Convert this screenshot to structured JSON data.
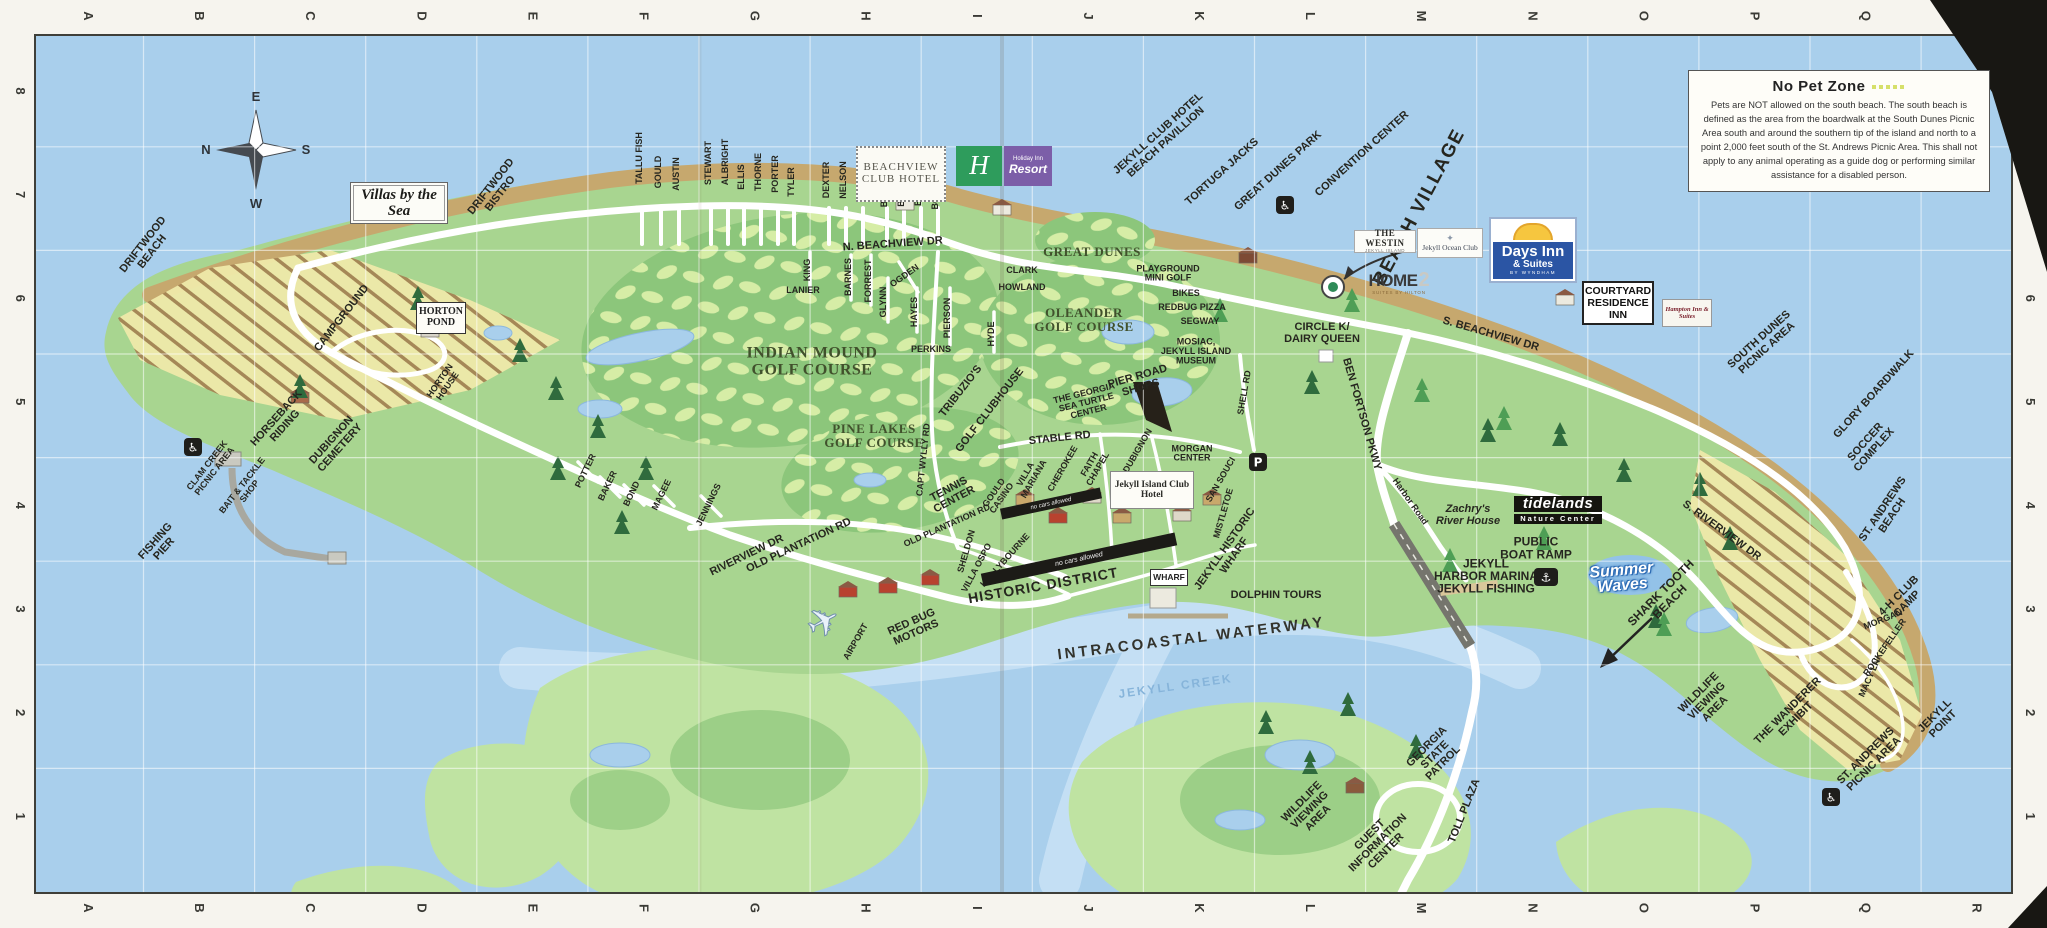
{
  "map": {
    "title": "Jekyll Island visitor map",
    "grid": {
      "columns": [
        "A",
        "B",
        "C",
        "D",
        "E",
        "F",
        "G",
        "H",
        "I",
        "J",
        "K",
        "L",
        "M",
        "N",
        "O",
        "P",
        "Q",
        "R"
      ],
      "rows_top_to_bottom": [
        "8",
        "7",
        "6",
        "5",
        "4",
        "3",
        "2",
        "1"
      ]
    },
    "no_pet_zone": {
      "title": "No Pet Zone",
      "body": "Pets are NOT allowed on the south beach. The south beach is defined as the area from the boardwalk at the South Dunes Picnic Area south and around the southern tip of the island and north to a point 2,000 feet south of the St. Andrews Picnic Area. This shall not apply to any animal operating as a guide dog or performing similar assistance for a disabled person."
    },
    "logos": {
      "villas": {
        "text": "Villas by the Sea"
      },
      "beachview": {
        "line1": "BEACHVIEW",
        "line2": "CLUB HOTEL"
      },
      "holiday": {
        "h": "H",
        "brand": "Holiday Inn",
        "sub": "Resort"
      },
      "westin": {
        "name": "THE WESTIN",
        "sub": "JEKYLL ISLAND"
      },
      "oceanclub": {
        "crest": "✦",
        "name": "Jekyll Ocean Club"
      },
      "days": {
        "name": "Days Inn",
        "sub": "& Suites",
        "tiny": "BY WYNDHAM"
      },
      "home2": {
        "name": "HOME",
        "num": "2",
        "sub": "SUITES BY HILTON"
      },
      "courtyard": {
        "line1": "COURTYARD",
        "line2": "RESIDENCE",
        "line3": "INN"
      },
      "hampton": {
        "name": "Hampton Inn & Suites"
      },
      "jekyllclub": {
        "name": "Jekyll Island Club Hotel"
      },
      "hortonpond": {
        "line1": "HORTON",
        "line2": "POND"
      },
      "wharf": {
        "name": "WHARF"
      },
      "tidelands": {
        "name": "tidelands",
        "sub": "Nature Center"
      },
      "summerwaves": {
        "line1": "Summer",
        "line2": "Waves"
      },
      "nocars": {
        "text": "no cars allowed"
      }
    },
    "icons": [
      {
        "type": "wheelchair",
        "g": "♿",
        "x": 193,
        "y": 447
      },
      {
        "type": "wheelchair",
        "g": "♿",
        "x": 1285,
        "y": 205
      },
      {
        "type": "wheelchair",
        "g": "♿",
        "x": 1831,
        "y": 797
      },
      {
        "type": "parking",
        "g": "P",
        "x": 1258,
        "y": 462
      },
      {
        "type": "boat-ramp",
        "g": "⚓",
        "x": 1546,
        "y": 577
      },
      {
        "type": "airplane",
        "g": "✈",
        "x": 830,
        "y": 634
      }
    ],
    "labels": [
      {
        "t": "N",
        "x": 206,
        "y": 154,
        "c": "lcomp"
      },
      {
        "t": "E",
        "x": 256,
        "y": 101,
        "c": "lcomp"
      },
      {
        "t": "S",
        "x": 306,
        "y": 154,
        "c": "lcomp"
      },
      {
        "t": "W",
        "x": 256,
        "y": 208,
        "c": "lcomp"
      },
      {
        "t": "DRIFTWOOD\nBEACH",
        "x": 150,
        "y": 250,
        "r": -52,
        "c": "ls"
      },
      {
        "t": "DRIFTWOOD\nBISTRO",
        "x": 498,
        "y": 192,
        "r": -52,
        "c": "ls"
      },
      {
        "t": "CAMPGROUND",
        "x": 344,
        "y": 320,
        "r": -52,
        "c": "ls"
      },
      {
        "t": "HORTON\nHOUSE",
        "x": 446,
        "y": 385,
        "r": -55,
        "c": "lt"
      },
      {
        "t": "HORSEBACK\nRIDING",
        "x": 283,
        "y": 424,
        "r": -48,
        "c": "ls"
      },
      {
        "t": "DUBIGNON\nCEMETERY",
        "x": 338,
        "y": 446,
        "r": -48,
        "c": "ls"
      },
      {
        "t": "CLAM CREEK\nPICNIC AREA",
        "x": 213,
        "y": 470,
        "r": -52,
        "c": "lt"
      },
      {
        "t": "BAIT & TACKLE\nSHOP",
        "x": 248,
        "y": 490,
        "r": -52,
        "c": "lt"
      },
      {
        "t": "FISHING\nPIER",
        "x": 162,
        "y": 547,
        "r": -48,
        "c": "ls"
      },
      {
        "t": "TALLU FISH",
        "x": 642,
        "y": 158,
        "r": -90,
        "c": "lt"
      },
      {
        "t": "GOULD",
        "x": 661,
        "y": 172,
        "r": -90,
        "c": "lt"
      },
      {
        "t": "AUSTIN",
        "x": 679,
        "y": 174,
        "r": -90,
        "c": "lt"
      },
      {
        "t": "STEWART",
        "x": 711,
        "y": 163,
        "r": -90,
        "c": "lt"
      },
      {
        "t": "ALBRIGHT",
        "x": 728,
        "y": 162,
        "r": -90,
        "c": "lt"
      },
      {
        "t": "ELLIS",
        "x": 744,
        "y": 177,
        "r": -90,
        "c": "lt"
      },
      {
        "t": "THORNE",
        "x": 761,
        "y": 172,
        "r": -90,
        "c": "lt"
      },
      {
        "t": "PORTER",
        "x": 778,
        "y": 174,
        "r": -90,
        "c": "lt"
      },
      {
        "t": "TYLER",
        "x": 794,
        "y": 182,
        "r": -90,
        "c": "lt"
      },
      {
        "t": "DEXTER",
        "x": 829,
        "y": 180,
        "r": -90,
        "c": "lt"
      },
      {
        "t": "NELSON",
        "x": 846,
        "y": 180,
        "r": -90,
        "c": "lt"
      },
      {
        "t": "KING",
        "x": 863,
        "y": 190,
        "r": -90,
        "c": "lt"
      },
      {
        "t": "BLISS",
        "x": 887,
        "y": 194,
        "r": -90,
        "c": "lt"
      },
      {
        "t": "BARRON",
        "x": 904,
        "y": 187,
        "r": -90,
        "c": "lt"
      },
      {
        "t": "BRICE",
        "x": 921,
        "y": 192,
        "r": -90,
        "c": "lt"
      },
      {
        "t": "BORDEN",
        "x": 938,
        "y": 190,
        "r": -90,
        "c": "lt"
      },
      {
        "t": "LANIER",
        "x": 803,
        "y": 293,
        "c": "lt"
      },
      {
        "t": "KING",
        "x": 810,
        "y": 270,
        "r": -90,
        "c": "lt"
      },
      {
        "t": "BARNES",
        "x": 851,
        "y": 277,
        "r": -90,
        "c": "lt"
      },
      {
        "t": "FORREST",
        "x": 871,
        "y": 281,
        "r": -90,
        "c": "lt"
      },
      {
        "t": "GLYNN",
        "x": 886,
        "y": 302,
        "r": -90,
        "c": "lt"
      },
      {
        "t": "OGDEN",
        "x": 906,
        "y": 278,
        "r": -35,
        "c": "lt"
      },
      {
        "t": "HAYES",
        "x": 917,
        "y": 312,
        "r": -90,
        "c": "lt"
      },
      {
        "t": "PIERSON",
        "x": 950,
        "y": 318,
        "r": -90,
        "c": "lt"
      },
      {
        "t": "PERKINS",
        "x": 931,
        "y": 352,
        "c": "lt"
      },
      {
        "t": "HYDE",
        "x": 994,
        "y": 334,
        "r": -90,
        "c": "lt"
      },
      {
        "t": "CLARK",
        "x": 1022,
        "y": 273,
        "c": "lt"
      },
      {
        "t": "HOWLAND",
        "x": 1022,
        "y": 290,
        "c": "lt"
      },
      {
        "t": "N. BEACHVIEW DR",
        "x": 893,
        "y": 247,
        "r": -4,
        "c": "ls"
      },
      {
        "t": "S. BEACHVIEW DR",
        "x": 1490,
        "y": 337,
        "r": 16,
        "c": "ls"
      },
      {
        "t": "OLD PLANTATION RD",
        "x": 800,
        "y": 548,
        "r": -25,
        "c": "ls"
      },
      {
        "t": "OLD PLANTATION RD",
        "x": 948,
        "y": 528,
        "r": -24,
        "c": "lt"
      },
      {
        "t": "RIVERVIEW DR",
        "x": 748,
        "y": 558,
        "r": -26,
        "c": "ls"
      },
      {
        "t": "CAPT WYLLY RD",
        "x": 926,
        "y": 460,
        "r": -84,
        "c": "lt"
      },
      {
        "t": "STABLE RD",
        "x": 1060,
        "y": 441,
        "r": -6,
        "c": "ls"
      },
      {
        "t": "SHELL RD",
        "x": 1247,
        "y": 393,
        "r": -80,
        "c": "lt"
      },
      {
        "t": "BEN FORTSON PKWY",
        "x": 1359,
        "y": 415,
        "r": 74,
        "c": "ls"
      },
      {
        "t": "Harbor Road",
        "x": 1408,
        "y": 503,
        "r": 55,
        "c": "lt"
      },
      {
        "t": "S. RIVERVIEW DR",
        "x": 1720,
        "y": 533,
        "r": 36,
        "c": "ls"
      },
      {
        "t": "TOLL PLAZA",
        "x": 1467,
        "y": 812,
        "r": -68,
        "c": "ls"
      },
      {
        "t": "MORGAN",
        "x": 1884,
        "y": 622,
        "r": -22,
        "c": "lt"
      },
      {
        "t": "ROCKEFELLER",
        "x": 1887,
        "y": 649,
        "r": -55,
        "c": "lt"
      },
      {
        "t": "MACY LN",
        "x": 1872,
        "y": 679,
        "r": -66,
        "c": "lt"
      },
      {
        "t": "POTTER",
        "x": 588,
        "y": 472,
        "r": -64,
        "c": "lt"
      },
      {
        "t": "BAKER",
        "x": 610,
        "y": 487,
        "r": -64,
        "c": "lt"
      },
      {
        "t": "BOND",
        "x": 634,
        "y": 495,
        "r": -64,
        "c": "lt"
      },
      {
        "t": "MAGEE",
        "x": 664,
        "y": 496,
        "r": -64,
        "c": "lt"
      },
      {
        "t": "JENNINGS",
        "x": 711,
        "y": 506,
        "r": -64,
        "c": "lt"
      },
      {
        "t": "INDIAN MOUND\nGOLF COURSE",
        "x": 812,
        "y": 366,
        "c": "lse"
      },
      {
        "t": "PINE LAKES\nGOLF COURSE",
        "x": 874,
        "y": 440,
        "c": "lse2"
      },
      {
        "t": "OLEANDER\nGOLF COURSE",
        "x": 1084,
        "y": 324,
        "c": "lse2"
      },
      {
        "t": "GREAT DUNES",
        "x": 1092,
        "y": 256,
        "c": "lse2"
      },
      {
        "t": "JEKYLL CLUB HOTEL\nBEACH PAVILLION",
        "x": 1164,
        "y": 140,
        "r": -42,
        "c": "ls"
      },
      {
        "t": "TORTUGA JACKS",
        "x": 1224,
        "y": 174,
        "r": -42,
        "c": "ls"
      },
      {
        "t": "GREAT DUNES PARK",
        "x": 1280,
        "y": 173,
        "r": -42,
        "c": "ls"
      },
      {
        "t": "CONVENTION CENTER",
        "x": 1364,
        "y": 156,
        "r": -42,
        "c": "ls"
      },
      {
        "t": "BEACH VILLAGE",
        "x": 1424,
        "y": 210,
        "r": -62,
        "c": "lbig"
      },
      {
        "t": "PLAYGROUND\nMINI GOLF",
        "x": 1168,
        "y": 276,
        "c": "lt"
      },
      {
        "t": "BIKES",
        "x": 1186,
        "y": 296,
        "c": "lt"
      },
      {
        "t": "REDBUG PIZZA",
        "x": 1192,
        "y": 310,
        "c": "lt"
      },
      {
        "t": "SEGWAY",
        "x": 1200,
        "y": 324,
        "c": "lt"
      },
      {
        "t": "MOSIAC,\nJEKYLL ISLAND\nMUSEUM",
        "x": 1196,
        "y": 354,
        "c": "lt"
      },
      {
        "t": "CIRCLE K/\nDAIRY QUEEN",
        "x": 1322,
        "y": 336,
        "c": "ls"
      },
      {
        "t": "TRIBUZIO'S",
        "x": 963,
        "y": 393,
        "r": -52,
        "c": "ls"
      },
      {
        "t": "GOLF CLUBHOUSE",
        "x": 992,
        "y": 412,
        "r": -52,
        "c": "ls"
      },
      {
        "t": "TENNIS\nCENTER",
        "x": 953,
        "y": 497,
        "r": -28,
        "c": "ls"
      },
      {
        "t": "THE GEORGIA\nSEA TURTLE\nCENTER",
        "x": 1087,
        "y": 405,
        "r": -14,
        "c": "lt"
      },
      {
        "t": "PIER ROAD\nSHOPS",
        "x": 1140,
        "y": 385,
        "r": -16,
        "c": "ls"
      },
      {
        "t": "GOULD\nCASINO",
        "x": 1000,
        "y": 497,
        "r": -55,
        "c": "lt"
      },
      {
        "t": "SHELDON",
        "x": 969,
        "y": 552,
        "r": -74,
        "c": "lt"
      },
      {
        "t": "VILLA OSPO",
        "x": 979,
        "y": 569,
        "r": -62,
        "c": "lt"
      },
      {
        "t": "HOLLYBOURNE",
        "x": 1007,
        "y": 562,
        "r": -48,
        "c": "lt"
      },
      {
        "t": "VILLA\nMARIANA",
        "x": 1032,
        "y": 478,
        "r": -60,
        "c": "lt"
      },
      {
        "t": "CHEROKEE",
        "x": 1065,
        "y": 470,
        "r": -60,
        "c": "lt"
      },
      {
        "t": "FAITH\nCHAPEL",
        "x": 1096,
        "y": 468,
        "r": -60,
        "c": "lt"
      },
      {
        "t": "DUBIGNON",
        "x": 1140,
        "y": 452,
        "r": -60,
        "c": "lt"
      },
      {
        "t": "MORGAN\nCENTER",
        "x": 1192,
        "y": 456,
        "c": "lt"
      },
      {
        "t": "SAN SOUCI",
        "x": 1223,
        "y": 481,
        "r": -60,
        "c": "lt"
      },
      {
        "t": "MISTLETOE",
        "x": 1226,
        "y": 514,
        "r": -74,
        "c": "lt"
      },
      {
        "t": "HISTORIC DISTRICT",
        "x": 1044,
        "y": 590,
        "r": -10,
        "c": "lhd"
      },
      {
        "t": "JEKYLL HISTORIC\nWHARF",
        "x": 1232,
        "y": 554,
        "r": -55,
        "c": "ls"
      },
      {
        "t": "DOLPHIN TOURS",
        "x": 1276,
        "y": 598,
        "c": "ls"
      },
      {
        "t": "AIRPORT",
        "x": 858,
        "y": 643,
        "r": -60,
        "c": "lt"
      },
      {
        "t": "RED BUG\nMOTORS",
        "x": 915,
        "y": 630,
        "r": -24,
        "c": "ls"
      },
      {
        "t": "INTRACOASTAL WATERWAY",
        "x": 1192,
        "y": 643,
        "r": -7,
        "c": "lws"
      },
      {
        "t": "JEKYLL CREEK",
        "x": 1176,
        "y": 690,
        "r": -8,
        "c": "lck"
      },
      {
        "t": "SOUTH DUNES\nPICNIC AREA",
        "x": 1765,
        "y": 346,
        "r": -42,
        "c": "ls"
      },
      {
        "t": "GLORY BOARDWALK",
        "x": 1876,
        "y": 396,
        "r": -48,
        "c": "ls"
      },
      {
        "t": "SOCCER\nCOMPLEX",
        "x": 1872,
        "y": 448,
        "r": -48,
        "c": "ls"
      },
      {
        "t": "ST. ANDREWS\nBEACH",
        "x": 1890,
        "y": 514,
        "r": -56,
        "c": "ls"
      },
      {
        "t": "4-H CLUB\nCAMP",
        "x": 1905,
        "y": 602,
        "r": -45,
        "c": "ls"
      },
      {
        "t": "Zachry's\nRiver House",
        "x": 1468,
        "y": 518,
        "c": "lzb"
      },
      {
        "t": "PUBLIC\nBOAT RAMP",
        "x": 1536,
        "y": 552,
        "c": "lm"
      },
      {
        "t": "JEKYLL\nHARBOR MARINA\nJEKYLL FISHING",
        "x": 1486,
        "y": 580,
        "c": "lm"
      },
      {
        "t": "SHARK TOOTH\nBEACH",
        "x": 1668,
        "y": 600,
        "r": -45,
        "c": "lm"
      },
      {
        "t": "WILDLIFE\nVIEWING\nAREA",
        "x": 1709,
        "y": 703,
        "r": -45,
        "c": "ls"
      },
      {
        "t": "THE WANDERER\nEXHIBIT",
        "x": 1794,
        "y": 717,
        "r": -45,
        "c": "ls"
      },
      {
        "t": "ST. ANDREWS\nPICNIC AREA",
        "x": 1872,
        "y": 762,
        "r": -45,
        "c": "ls"
      },
      {
        "t": "JEKYLL\nPOINT",
        "x": 1941,
        "y": 722,
        "r": -45,
        "c": "ls"
      },
      {
        "t": "WILDLIFE\nVIEWING\nAREA",
        "x": 1312,
        "y": 812,
        "r": -45,
        "c": "ls"
      },
      {
        "t": "GUEST\nINFORMATION\nCENTER",
        "x": 1380,
        "y": 845,
        "r": -45,
        "c": "ls"
      },
      {
        "t": "GEORGIA\nSTATE\nPATROL",
        "x": 1437,
        "y": 757,
        "r": -45,
        "c": "ls"
      }
    ],
    "colors": {
      "water": "#a9cfec",
      "land": "#a8d590",
      "marsh": "#bfe3a2",
      "beach": "#c6a86e",
      "golf": "#8cc67b",
      "fairway": "#d6eda6",
      "road": "#ffffff",
      "hatch_bg": "#efe9a9",
      "hatch_line": "#a58454",
      "days_inn_blue": "#2b55a4",
      "holiday_green": "#2e9c5c",
      "holiday_purple": "#7c5ea8",
      "nopet_dash": "#d6e06a"
    }
  }
}
